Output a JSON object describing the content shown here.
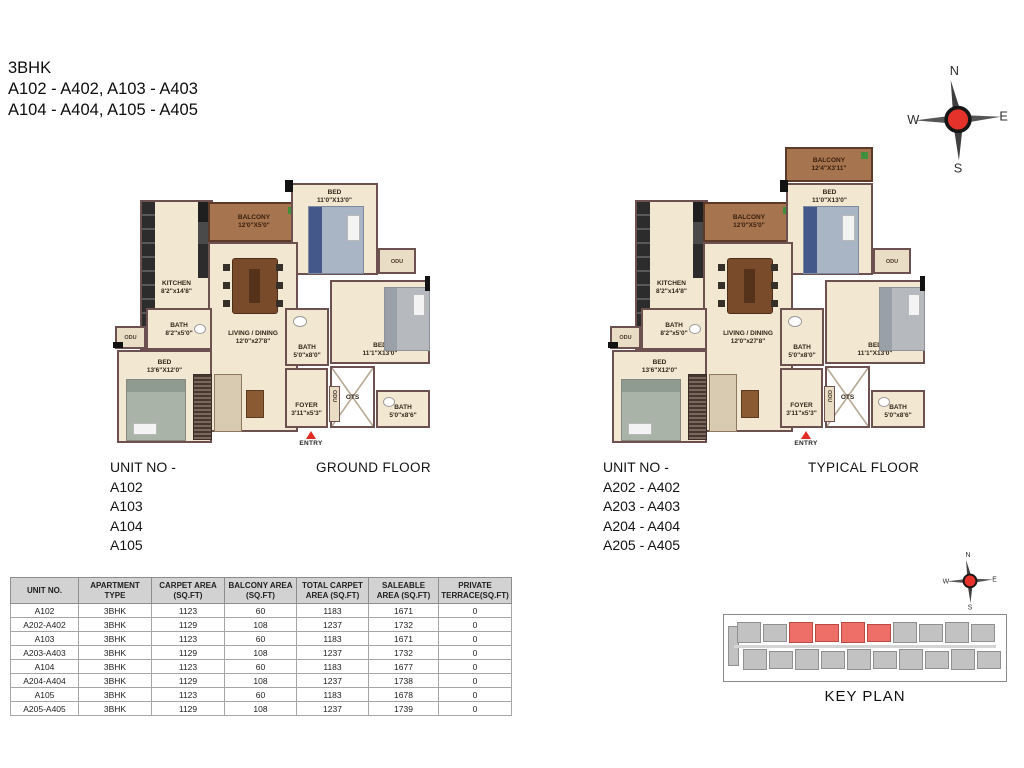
{
  "title": {
    "line1": "3BHK",
    "line2": "A102 - A402, A103 - A403",
    "line3": "A104 - A404, A105 - A405"
  },
  "compass": {
    "n": "N",
    "e": "E",
    "s": "S",
    "w": "W"
  },
  "plans": {
    "ground": {
      "floor_label": "GROUND FLOOR",
      "unit_heading": "UNIT NO -",
      "units": [
        "A102",
        "A103",
        "A104",
        "A105"
      ],
      "rooms": {
        "balcony": {
          "name": "BALCONY",
          "dims": "12'0\"X5'0\""
        },
        "bed_top": {
          "name": "BED",
          "dims": "11'0\"X13'0\""
        },
        "kitchen": {
          "name": "KITCHEN",
          "dims": "8'2\"x14'8\""
        },
        "living": {
          "name": "LIVING / DINING",
          "dims": "12'0\"x27'8\""
        },
        "bath_left": {
          "name": "BATH",
          "dims": "8'2\"x5'0\""
        },
        "bed_left": {
          "name": "BED",
          "dims": "13'6\"X12'0\""
        },
        "bath_mid": {
          "name": "BATH",
          "dims": "5'0\"x8'0\""
        },
        "bed_right": {
          "name": "BED",
          "dims": "11'1\"X13'0\""
        },
        "ots": {
          "name": "OTS"
        },
        "foyer": {
          "name": "FOYER",
          "dims": "3'11\"x5'3\""
        },
        "bath_right": {
          "name": "BATH",
          "dims": "5'0\"x8'6\""
        },
        "entry": {
          "label": "ENTRY"
        },
        "odu": {
          "label": "ODU"
        }
      }
    },
    "typical": {
      "floor_label": "TYPICAL FLOOR",
      "unit_heading": "UNIT NO -",
      "units": [
        "A202 - A402",
        "A203 - A403",
        "A204 - A404",
        "A205 - A405"
      ],
      "rooms": {
        "balcony_top": {
          "name": "BALCONY",
          "dims": "12'4\"X3'11\""
        },
        "balcony": {
          "name": "BALCONY",
          "dims": "12'0\"X5'0\""
        },
        "bed_top": {
          "name": "BED",
          "dims": "11'0\"X13'0\""
        },
        "kitchen": {
          "name": "KITCHEN",
          "dims": "8'2\"x14'8\""
        },
        "living": {
          "name": "LIVING / DINING",
          "dims": "12'0\"x27'8\""
        },
        "bath_left": {
          "name": "BATH",
          "dims": "8'2\"x5'0\""
        },
        "bed_left": {
          "name": "BED",
          "dims": "13'6\"X12'0\""
        },
        "bath_mid": {
          "name": "BATH",
          "dims": "5'0\"x8'0\""
        },
        "bed_right": {
          "name": "BED",
          "dims": "11'1\"X13'0\""
        },
        "ots": {
          "name": "OTS"
        },
        "foyer": {
          "name": "FOYER",
          "dims": "3'11\"x5'3\""
        },
        "bath_right": {
          "name": "BATH",
          "dims": "5'0\"x8'6\""
        },
        "entry": {
          "label": "ENTRY"
        },
        "odu": {
          "label": "ODU"
        }
      }
    }
  },
  "table": {
    "headers": [
      "UNIT NO.",
      "APARTMENT TYPE",
      "CARPET AREA (SQ.FT)",
      "BALCONY AREA (SQ.FT)",
      "TOTAL CARPET AREA (SQ.FT)",
      "SALEABLE AREA (SQ.FT)",
      "PRIVATE TERRACE(SQ.FT)"
    ],
    "rows": [
      [
        "A102",
        "3BHK",
        "1123",
        "60",
        "1183",
        "1671",
        "0"
      ],
      [
        "A202-A402",
        "3BHK",
        "1129",
        "108",
        "1237",
        "1732",
        "0"
      ],
      [
        "A103",
        "3BHK",
        "1123",
        "60",
        "1183",
        "1671",
        "0"
      ],
      [
        "A203-A403",
        "3BHK",
        "1129",
        "108",
        "1237",
        "1732",
        "0"
      ],
      [
        "A104",
        "3BHK",
        "1123",
        "60",
        "1183",
        "1677",
        "0"
      ],
      [
        "A204-A404",
        "3BHK",
        "1129",
        "108",
        "1237",
        "1738",
        "0"
      ],
      [
        "A105",
        "3BHK",
        "1123",
        "60",
        "1183",
        "1678",
        "0"
      ],
      [
        "A205-A405",
        "3BHK",
        "1129",
        "108",
        "1237",
        "1739",
        "0"
      ]
    ]
  },
  "keyplan": {
    "label": "KEY PLAN"
  },
  "colors": {
    "wall": "#6d5050",
    "floor": "#f2e7d0",
    "balcony_wood": "#a6744e",
    "accent_red": "#df2b22",
    "compass_red": "#e5332b",
    "keyplan_highlight": "#ee6f67",
    "table_header_bg": "#d2d2d2"
  }
}
